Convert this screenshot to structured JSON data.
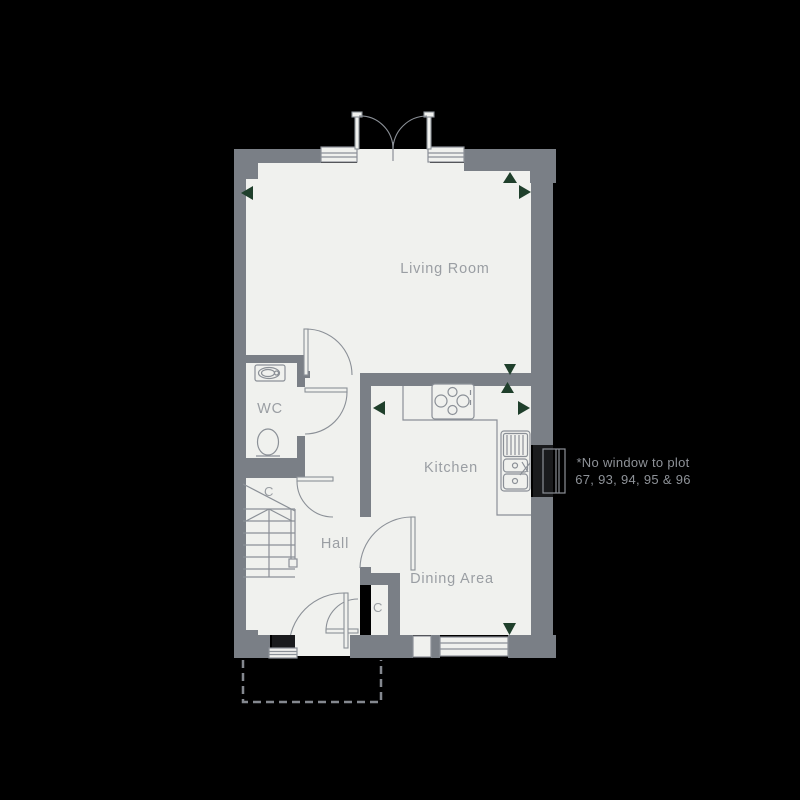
{
  "plan": {
    "rooms": {
      "living_room": "Living Room",
      "wc": "WC",
      "hall": "Hall",
      "kitchen": "Kitchen",
      "dining_area": "Dining Area"
    },
    "cupboard_label": "C",
    "note": {
      "line1": "*No window to plot",
      "line2": "67, 93, 94, 95 & 96"
    },
    "colors": {
      "background": "#000000",
      "wall": "#7a7f86",
      "floor": "#f0f1ee",
      "fixture_line": "#8b9097",
      "label_text": "#9a9ea3",
      "note_text": "#8e9298",
      "marker_green": "#1f3f2b",
      "blocked_window": "#1a1b1d"
    }
  }
}
